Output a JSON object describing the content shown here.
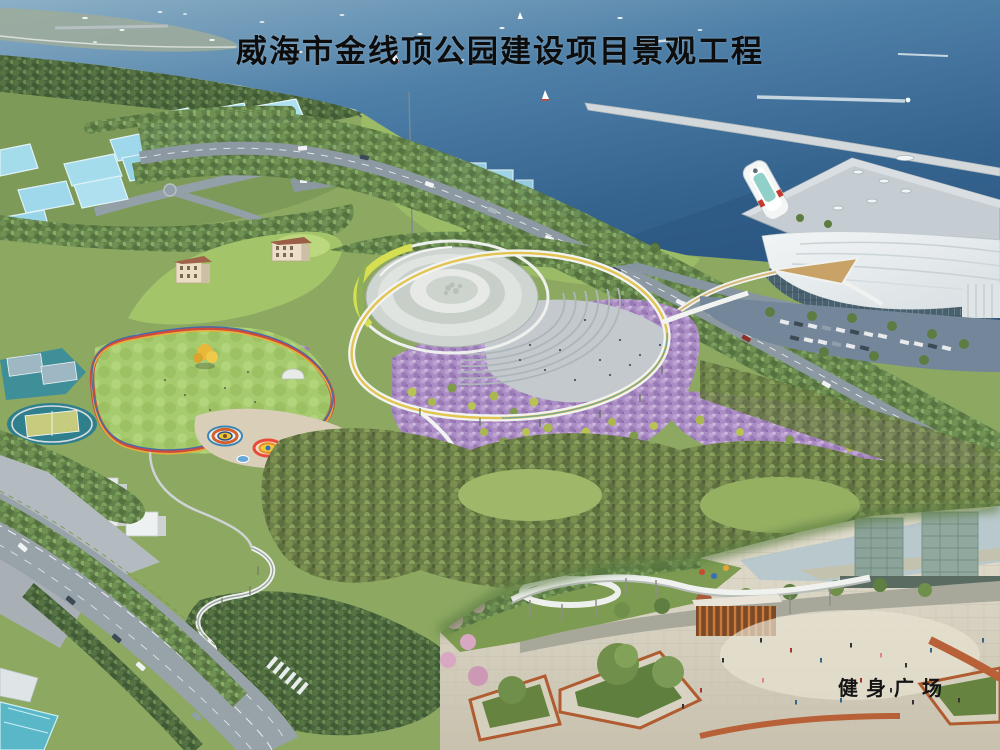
{
  "title_bar": {
    "text": "威海市金线顶公园建设项目景观工程"
  },
  "inset": {
    "caption": "健身广场"
  },
  "palette": {
    "sea_deep": "#2e5c8a",
    "sea_light": "#7fa6c0",
    "breakwater": "#d3d8da",
    "land_base": "#8ca861",
    "forest_dark": "#4a653b",
    "forest_mid": "#62824a",
    "forest_olive": "#6d7f48",
    "lawn": "#a6ca6e",
    "lavender_field": "#ab8cc4",
    "track_red": "#cf4a3c",
    "road_gray": "#8d99a2",
    "glass_residential": "#a5dcec",
    "dome_building": "#d5dad6",
    "terminal_white": "#e9edee",
    "cruise_red": "#c23b30",
    "plaza_pale": "#ddd6c6",
    "pavilion_orange": "#cc7a3a",
    "title_color": "#0d0d0d"
  }
}
